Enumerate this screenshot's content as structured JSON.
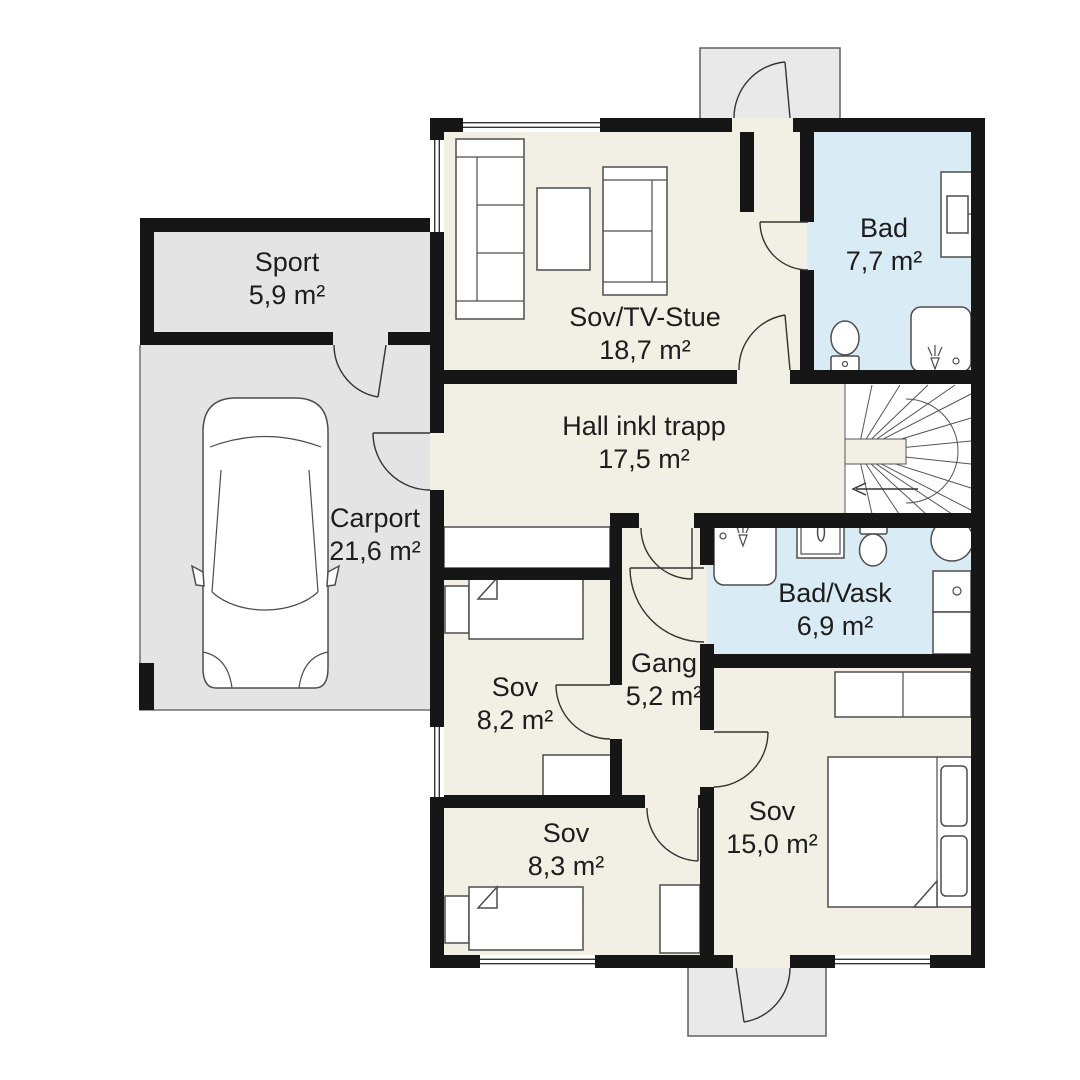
{
  "plan_title": "Floor plan with room areas",
  "rooms": [
    {
      "name": "Sport",
      "area": "5,9 m²"
    },
    {
      "name": "Carport",
      "area": "21,6 m²"
    },
    {
      "name": "Sov/TV-Stue",
      "area": "18,7 m²"
    },
    {
      "name": "Bad",
      "area": "7,7 m²"
    },
    {
      "name": "Hall inkl trapp",
      "area": "17,5 m²"
    },
    {
      "name": "Bad/Vask",
      "area": "6,9 m²"
    },
    {
      "name": "Sov",
      "area": "8,2 m²"
    },
    {
      "name": "Gang",
      "area": "5,2 m²"
    },
    {
      "name": "Sov",
      "area": "15,0 m²"
    },
    {
      "name": "Sov",
      "area": "8,3 m²"
    }
  ],
  "colors": {
    "floor_dry": "#f2efe5",
    "floor_wet": "#d9ebf5",
    "floor_garage": "#e4e4e4",
    "floor_porch": "#e9e9e9",
    "wall": "#161616",
    "label_text": "#1d1d1d"
  }
}
